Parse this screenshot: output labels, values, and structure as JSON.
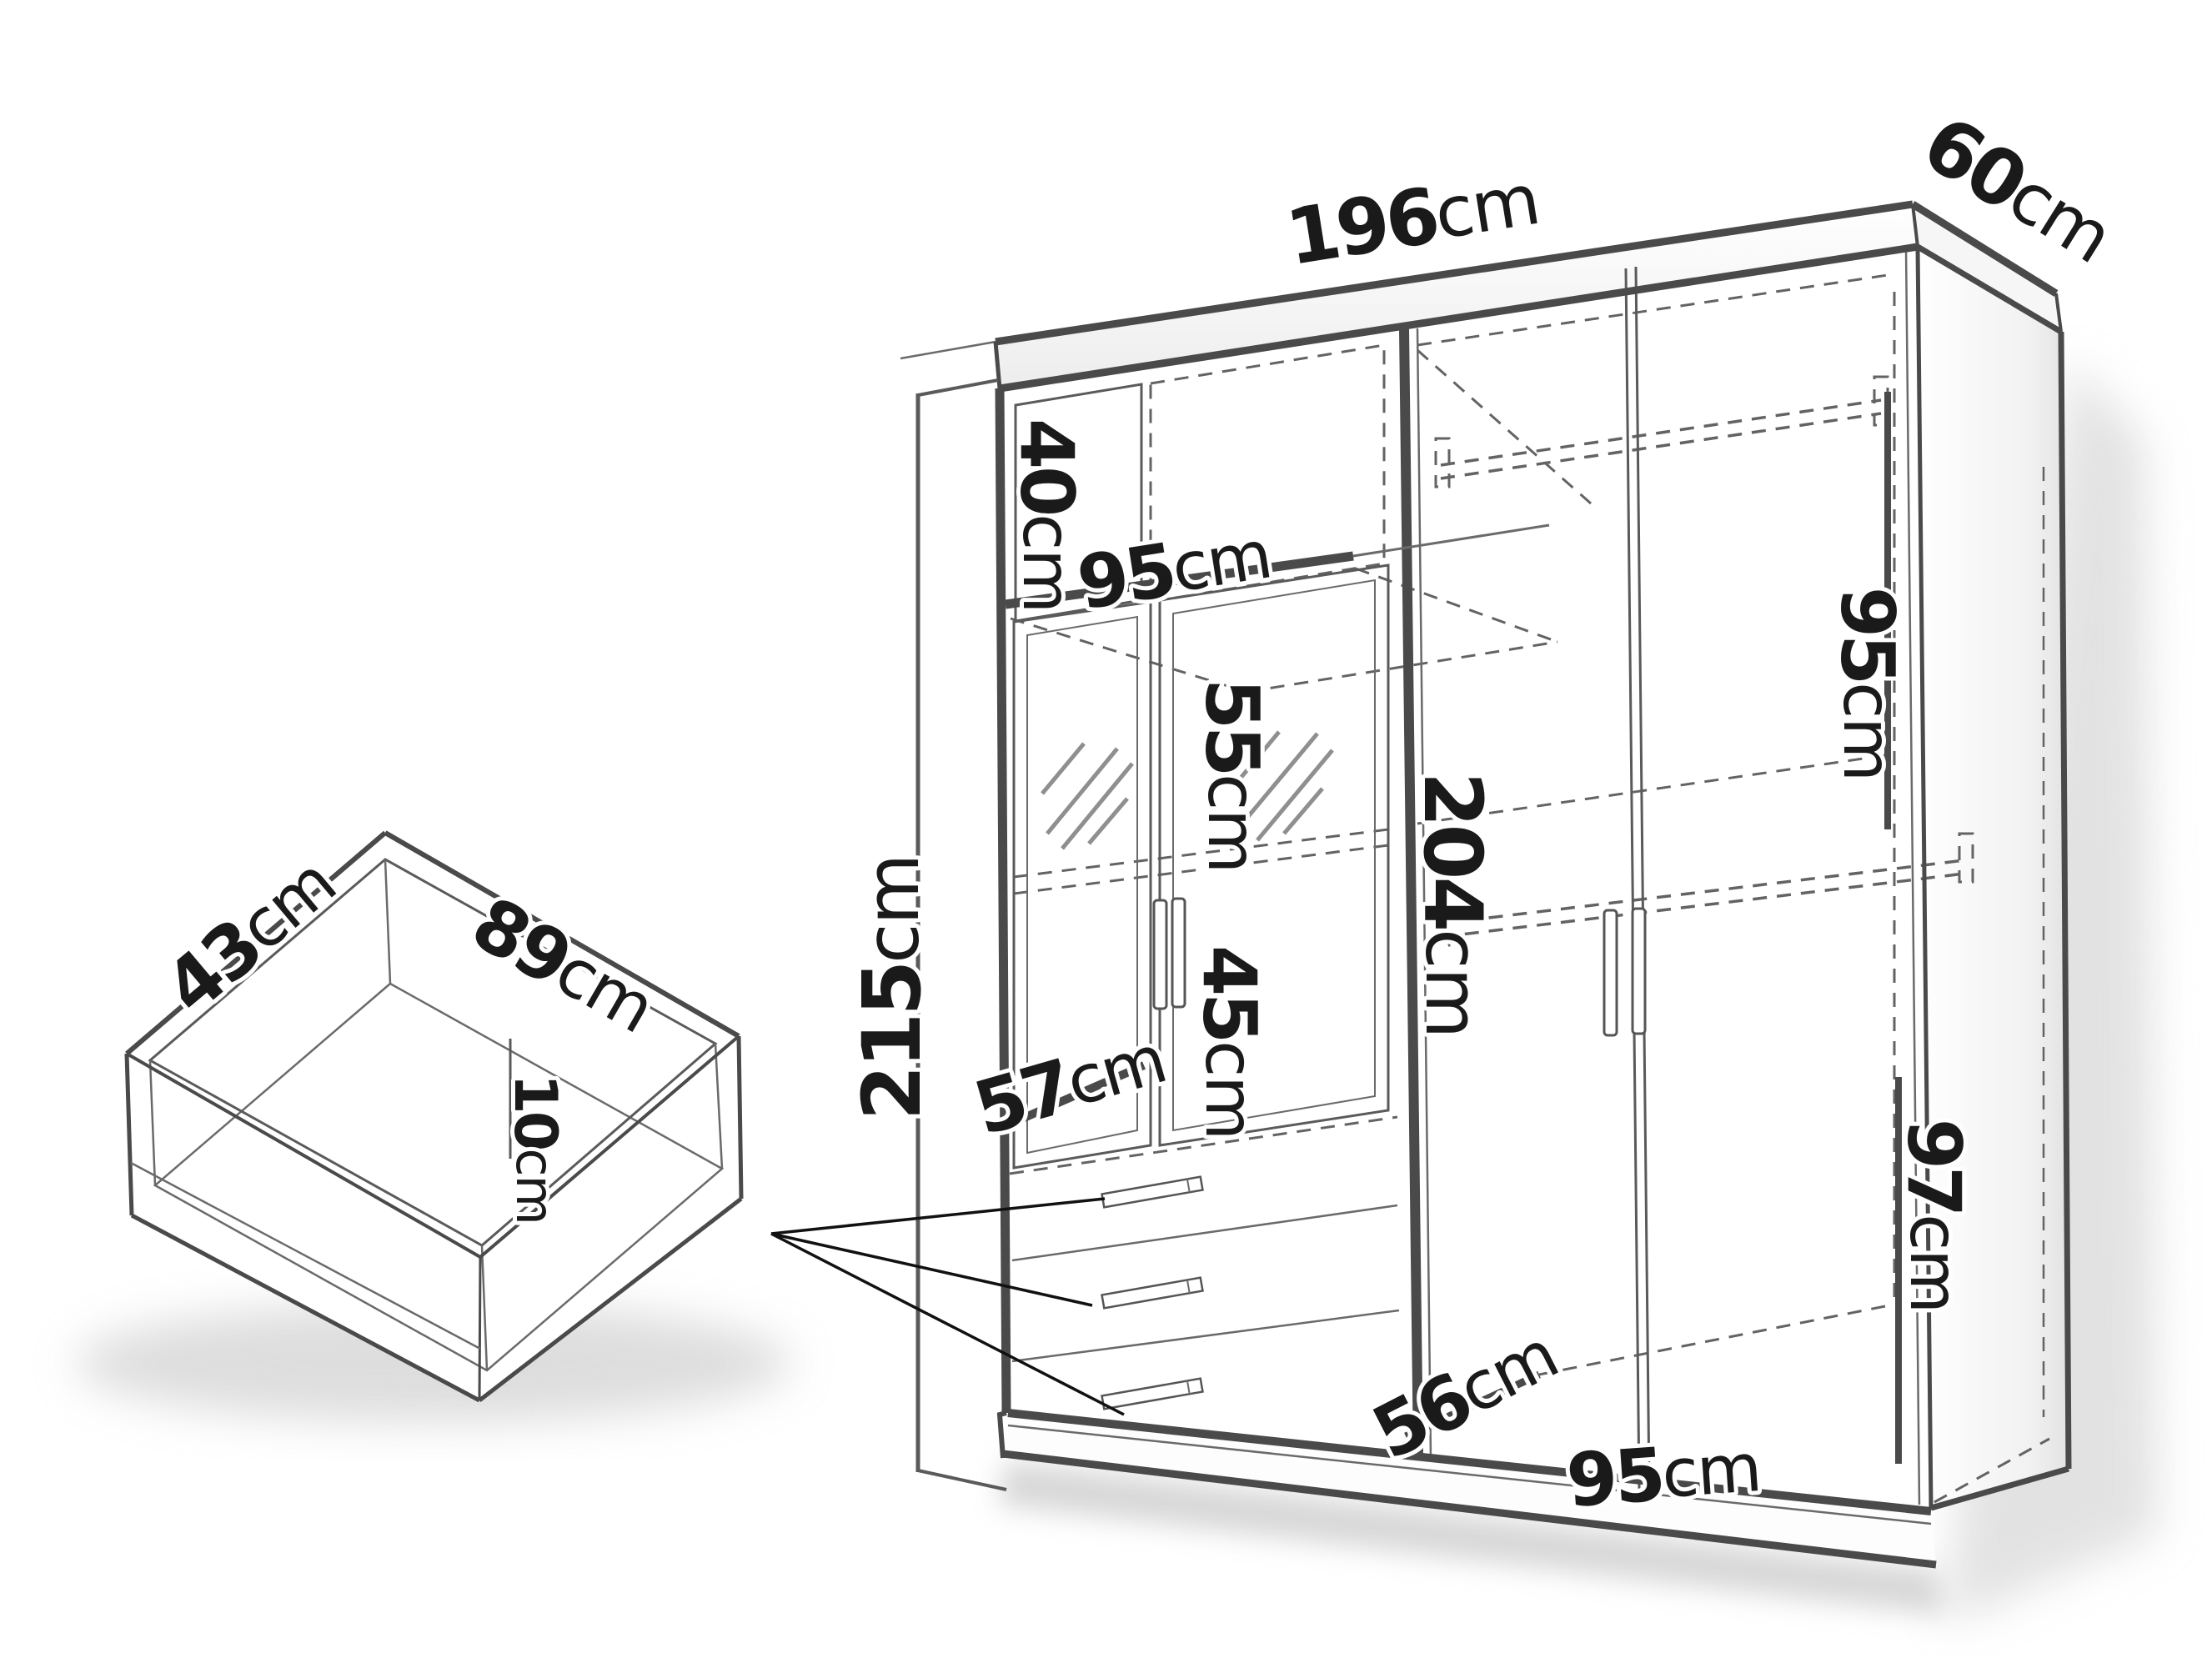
{
  "diagram": {
    "type": "furniture-dimension-drawing",
    "subject": "three-section wardrobe with mirror doors, drawers and pull-out drawer box",
    "unit": "cm",
    "colors": {
      "ink": "#1a1a1a",
      "line": "#4a4a4a",
      "dash": "#636363",
      "shadow": "#bfbfbf",
      "background": "#ffffff"
    }
  },
  "dims": {
    "width_top": {
      "value": "196",
      "unit": "cm"
    },
    "depth_top": {
      "value": "60",
      "unit": "cm"
    },
    "height_left": {
      "value": "215",
      "unit": "cm"
    },
    "cubby_height": {
      "value": "40",
      "unit": "cm"
    },
    "shelf_width": {
      "value": "95",
      "unit": "cm"
    },
    "mirror_upper_height": {
      "value": "55",
      "unit": "cm"
    },
    "interior_height": {
      "value": "204",
      "unit": "cm"
    },
    "mirror_lower_height": {
      "value": "45",
      "unit": "cm"
    },
    "drawer_section_width": {
      "value": "57",
      "unit": "cm"
    },
    "right_upper_height": {
      "value": "95",
      "unit": "cm"
    },
    "right_lower_height": {
      "value": "97",
      "unit": "cm"
    },
    "floor_depth": {
      "value": "56",
      "unit": "cm"
    },
    "bottom_width": {
      "value": "95",
      "unit": "cm"
    },
    "drawer_depth": {
      "value": "43",
      "unit": "cm"
    },
    "drawer_width": {
      "value": "89",
      "unit": "cm"
    },
    "drawer_height": {
      "value": "10",
      "unit": "cm"
    }
  }
}
